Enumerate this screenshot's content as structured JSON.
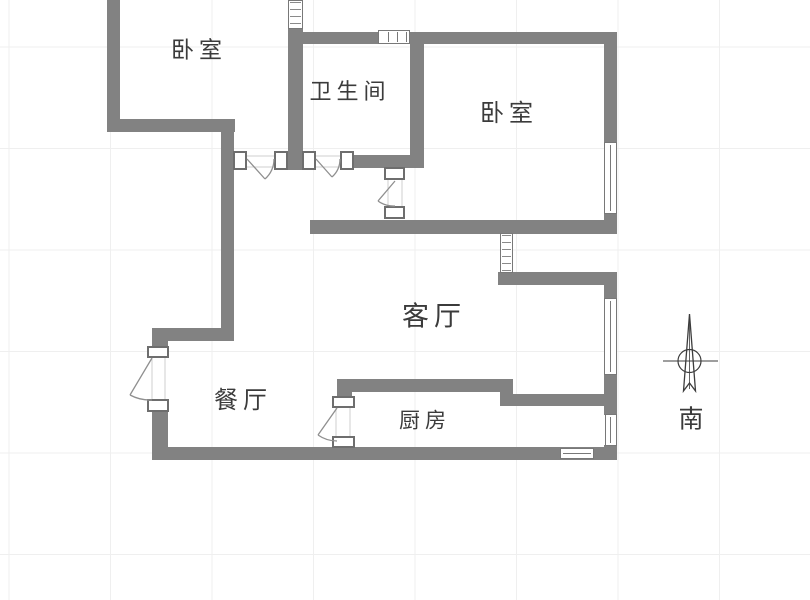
{
  "plan_title": "apartment-floor-plan",
  "rooms": {
    "bedroom_left": {
      "label": "卧室"
    },
    "bathroom": {
      "label": "卫生间"
    },
    "bedroom_right": {
      "label": "卧室"
    },
    "living": {
      "label": "客厅"
    },
    "dining": {
      "label": "餐厅"
    },
    "kitchen": {
      "label": "厨房"
    }
  },
  "compass": {
    "south_label": "南"
  },
  "colors": {
    "wall": "#828282",
    "door_frame_border": "#6e6e6e",
    "door_swing_line": "#8f8f8f",
    "window_line": "#787878",
    "grid_line": "#efefef",
    "text": "#3b3b3b",
    "background": "#ffffff"
  }
}
